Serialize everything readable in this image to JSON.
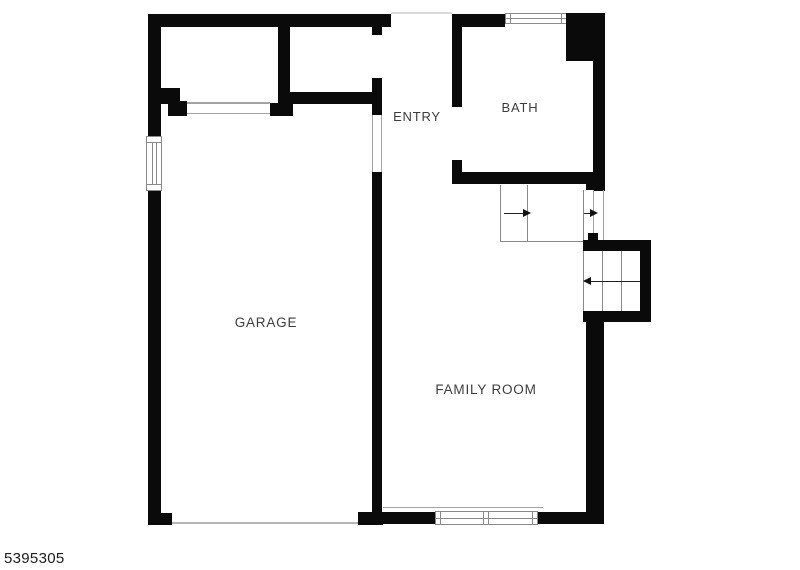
{
  "floorplan": {
    "listing_id": "5395305",
    "rooms": [
      {
        "name": "garage",
        "label": "GARAGE"
      },
      {
        "name": "entry",
        "label": "ENTRY"
      },
      {
        "name": "bath",
        "label": "BATH"
      },
      {
        "name": "family_room",
        "label": "FAMILY ROOM"
      }
    ],
    "icons": {
      "stair_arrow_up_run": "triangle-right",
      "stair_arrow_landing": "triangle-right",
      "stair_arrow_down_run": "triangle-left"
    },
    "colors": {
      "wall": "#0a0a0a",
      "background": "#ffffff",
      "thin_line": "#a3a3a3",
      "window_frame": "#8a8a8a",
      "room_label": "#3d3d3d",
      "listing_id_text": "#1c1c1c"
    }
  }
}
